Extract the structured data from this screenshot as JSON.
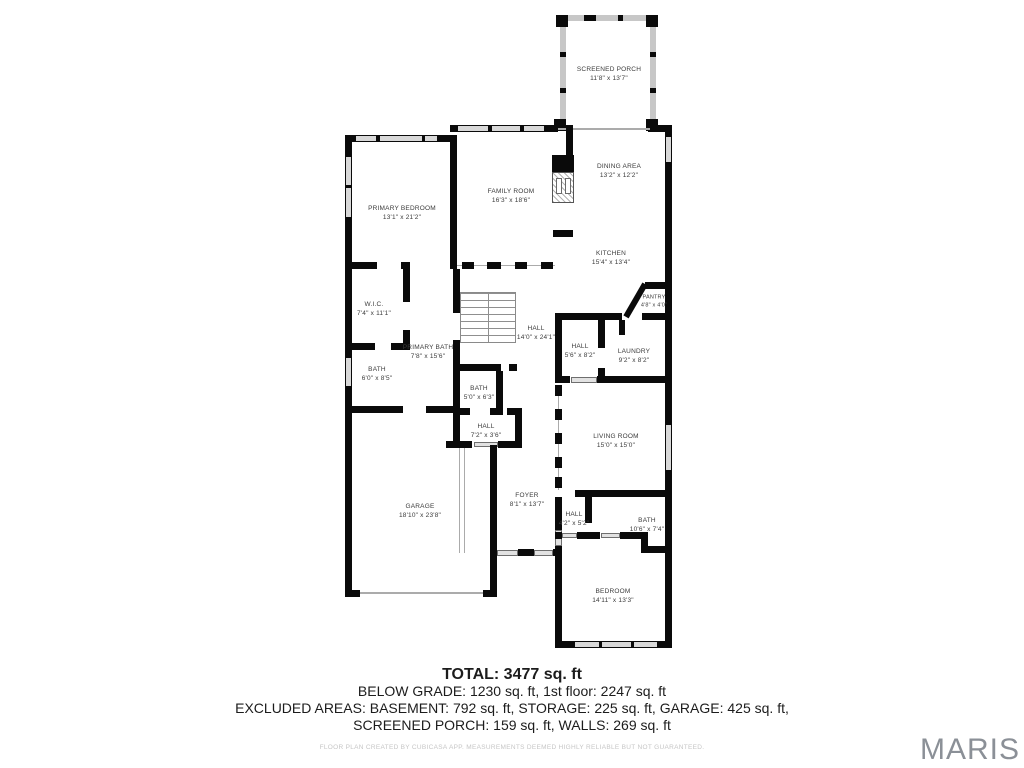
{
  "rooms": {
    "screened_porch": {
      "name": "SCREENED PORCH",
      "dims": "11'8\" x 13'7\""
    },
    "primary_bedroom": {
      "name": "PRIMARY BEDROOM",
      "dims": "13'1\" x 21'2\""
    },
    "family_room": {
      "name": "FAMILY ROOM",
      "dims": "16'3\" x 18'6\""
    },
    "dining_area": {
      "name": "DINING AREA",
      "dims": "13'2\" x 12'2\""
    },
    "kitchen": {
      "name": "KITCHEN",
      "dims": "15'4\" x 13'4\""
    },
    "pantry": {
      "name": "PANTRY",
      "dims": "4'8\" x 4'0\""
    },
    "wic": {
      "name": "W.I.C.",
      "dims": "7'4\" x 11'1\""
    },
    "primary_bath": {
      "name": "PRIMARY BATH",
      "dims": "7'8\" x 15'6\""
    },
    "hall_main": {
      "name": "HALL",
      "dims": "14'0\" x 24'1\""
    },
    "hall_small": {
      "name": "HALL",
      "dims": "5'6\" x 8'2\""
    },
    "laundry": {
      "name": "LAUNDRY",
      "dims": "9'2\" x 8'2\""
    },
    "bath_left": {
      "name": "BATH",
      "dims": "6'0\" x 8'5\""
    },
    "bath_center": {
      "name": "BATH",
      "dims": "5'0\" x 6'3\""
    },
    "hall_lower": {
      "name": "HALL",
      "dims": "7'2\" x 3'6\""
    },
    "living_room": {
      "name": "LIVING ROOM",
      "dims": "15'0\" x 15'0\""
    },
    "garage": {
      "name": "GARAGE",
      "dims": "18'10\" x 23'8\""
    },
    "foyer": {
      "name": "FOYER",
      "dims": "8'1\" x 13'7\""
    },
    "hall_bedroom": {
      "name": "HALL",
      "dims": "4'2\" x 5'2\""
    },
    "bath_hall": {
      "name": "BATH",
      "dims": "10'6\" x 7'4\""
    },
    "bedroom": {
      "name": "BEDROOM",
      "dims": "14'11\" x 13'3\""
    }
  },
  "summary": {
    "total": "TOTAL: 3477 sq. ft",
    "line2": "BELOW GRADE: 1230 sq. ft, 1st floor: 2247 sq. ft",
    "line3": "EXCLUDED AREAS: BASEMENT: 792 sq. ft, STORAGE: 225 sq. ft, GARAGE: 425 sq. ft,",
    "line4": "SCREENED PORCH: 159 sq. ft, WALLS: 269 sq. ft"
  },
  "footer": {
    "disclaimer": "FLOOR PLAN CREATED BY CUBICASA APP. MEASUREMENTS DEEMED HIGHLY RELIABLE BUT NOT GUARANTEED.",
    "brand": "MARIS"
  },
  "colors": {
    "wall": "#0a0a0a",
    "window": "#d8d8d8",
    "screen_wall": "#c7c7c7",
    "text": "#3b3b3b",
    "brand": "#8b9097"
  }
}
